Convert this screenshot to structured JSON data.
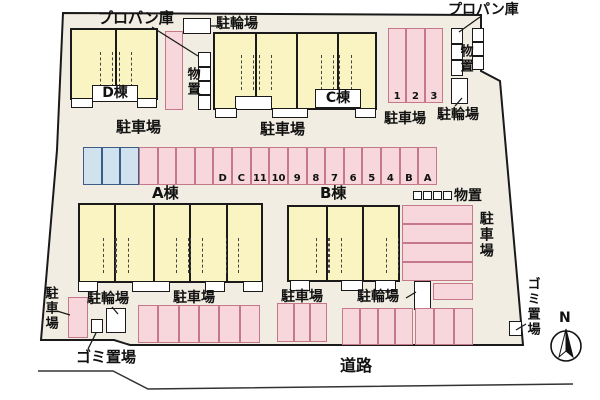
{
  "labels": {
    "propane_nw": "プロパン庫",
    "bicycle_n": "駐輪場",
    "storage_nw": "物置",
    "building_d": "D棟",
    "parking_d": "駐車場",
    "building_c": "C棟",
    "parking_c": "駐車場",
    "propane_ne": "プロパン庫",
    "storage_ne": "物置",
    "parking_ne": "駐車場",
    "bicycle_ne": "駐輪場",
    "building_a": "A棟",
    "building_b": "B棟",
    "storage_e": "物置",
    "parking_e": "駐車場",
    "parking_w": "駐車場",
    "bicycle_sw": "駐輪場",
    "garbage_sw": "ゴミ置場",
    "parking_s_a": "駐車場",
    "parking_s_b": "駐車場",
    "bicycle_s_b": "駐輪場",
    "garbage_se": "ゴミ置場",
    "road": "道路",
    "north": "N"
  },
  "middle_row_spots": [
    {
      "color": "blue",
      "label": ""
    },
    {
      "color": "blue",
      "label": ""
    },
    {
      "color": "blue",
      "label": ""
    },
    {
      "color": "pink",
      "label": ""
    },
    {
      "color": "pink",
      "label": ""
    },
    {
      "color": "pink",
      "label": ""
    },
    {
      "color": "pink",
      "label": ""
    },
    {
      "color": "pink",
      "label": "D"
    },
    {
      "color": "pink",
      "label": "C"
    },
    {
      "color": "pink",
      "label": "11"
    },
    {
      "color": "pink",
      "label": "10"
    },
    {
      "color": "pink",
      "label": "9"
    },
    {
      "color": "pink",
      "label": "8"
    },
    {
      "color": "pink",
      "label": "7"
    },
    {
      "color": "pink",
      "label": "6"
    },
    {
      "color": "pink",
      "label": "5"
    },
    {
      "color": "pink",
      "label": "4"
    },
    {
      "color": "pink",
      "label": "B"
    },
    {
      "color": "pink",
      "label": "A"
    }
  ],
  "numbered_spots": [
    "1",
    "2",
    "3"
  ],
  "east_parking_rows": 4,
  "bottom_parking_counts": [
    6,
    3,
    4,
    3
  ],
  "colors": {
    "site_bg": "#f1ede2",
    "building_fill": "#faf4c3",
    "parking_pink": "#f8d7dc",
    "parking_pink_border": "#c4788a",
    "parking_blue": "#cfe2ee",
    "parking_blue_border": "#3d5c86",
    "outline": "#1a1a1a"
  }
}
